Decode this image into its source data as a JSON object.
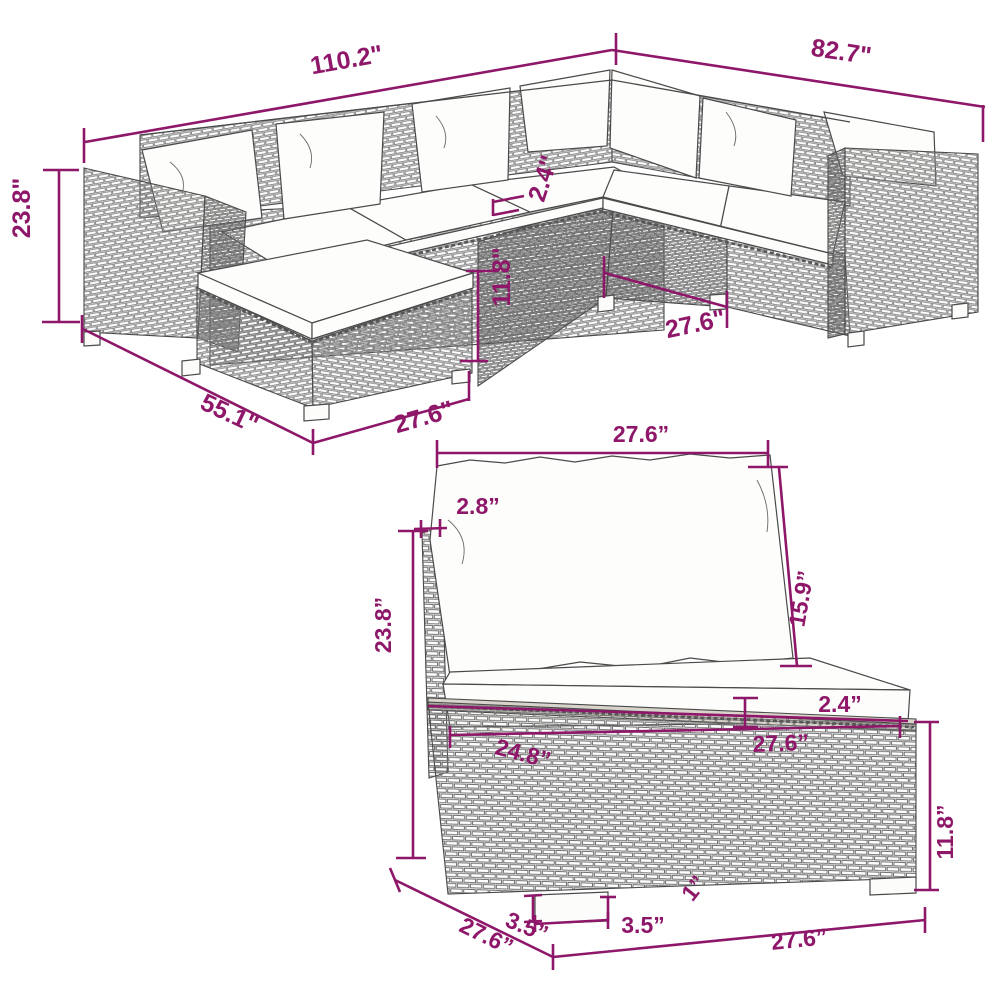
{
  "diagram": {
    "subject": "rattan sectional sofa set dimension drawing",
    "views": [
      "sectional overview",
      "middle section detail"
    ]
  },
  "colors": {
    "dimension": "#8e1769",
    "linework": "#4a4a4a",
    "cushion": "#fdfdfb",
    "background": "#ffffff"
  },
  "overview": {
    "name": "sectional-overview",
    "dims": {
      "total_width": "110.2\"",
      "total_depth": "82.7\"",
      "height": "23.8\"",
      "cushion_thickness": "2.4\"",
      "base_height": "11.8\"",
      "section_width": "27.6\"",
      "chaise_depth": "55.1\"",
      "ottoman_width": "27.6\""
    }
  },
  "module": {
    "name": "middle-section-detail",
    "dims": {
      "top_width": "27.6”",
      "frame_thickness": "2.8”",
      "total_height": "23.8”",
      "back_cushion_height": "15.9”",
      "seat_cushion_thickness": "2.4”",
      "inner_width": "24.8”",
      "platform_width": "27.6”",
      "base_height": "11.8”",
      "foot_detail": "1”",
      "leg_height": "3.5”",
      "leg_width": "3.5”",
      "depth": "27.6”",
      "bottom_width": "27.6”"
    }
  }
}
